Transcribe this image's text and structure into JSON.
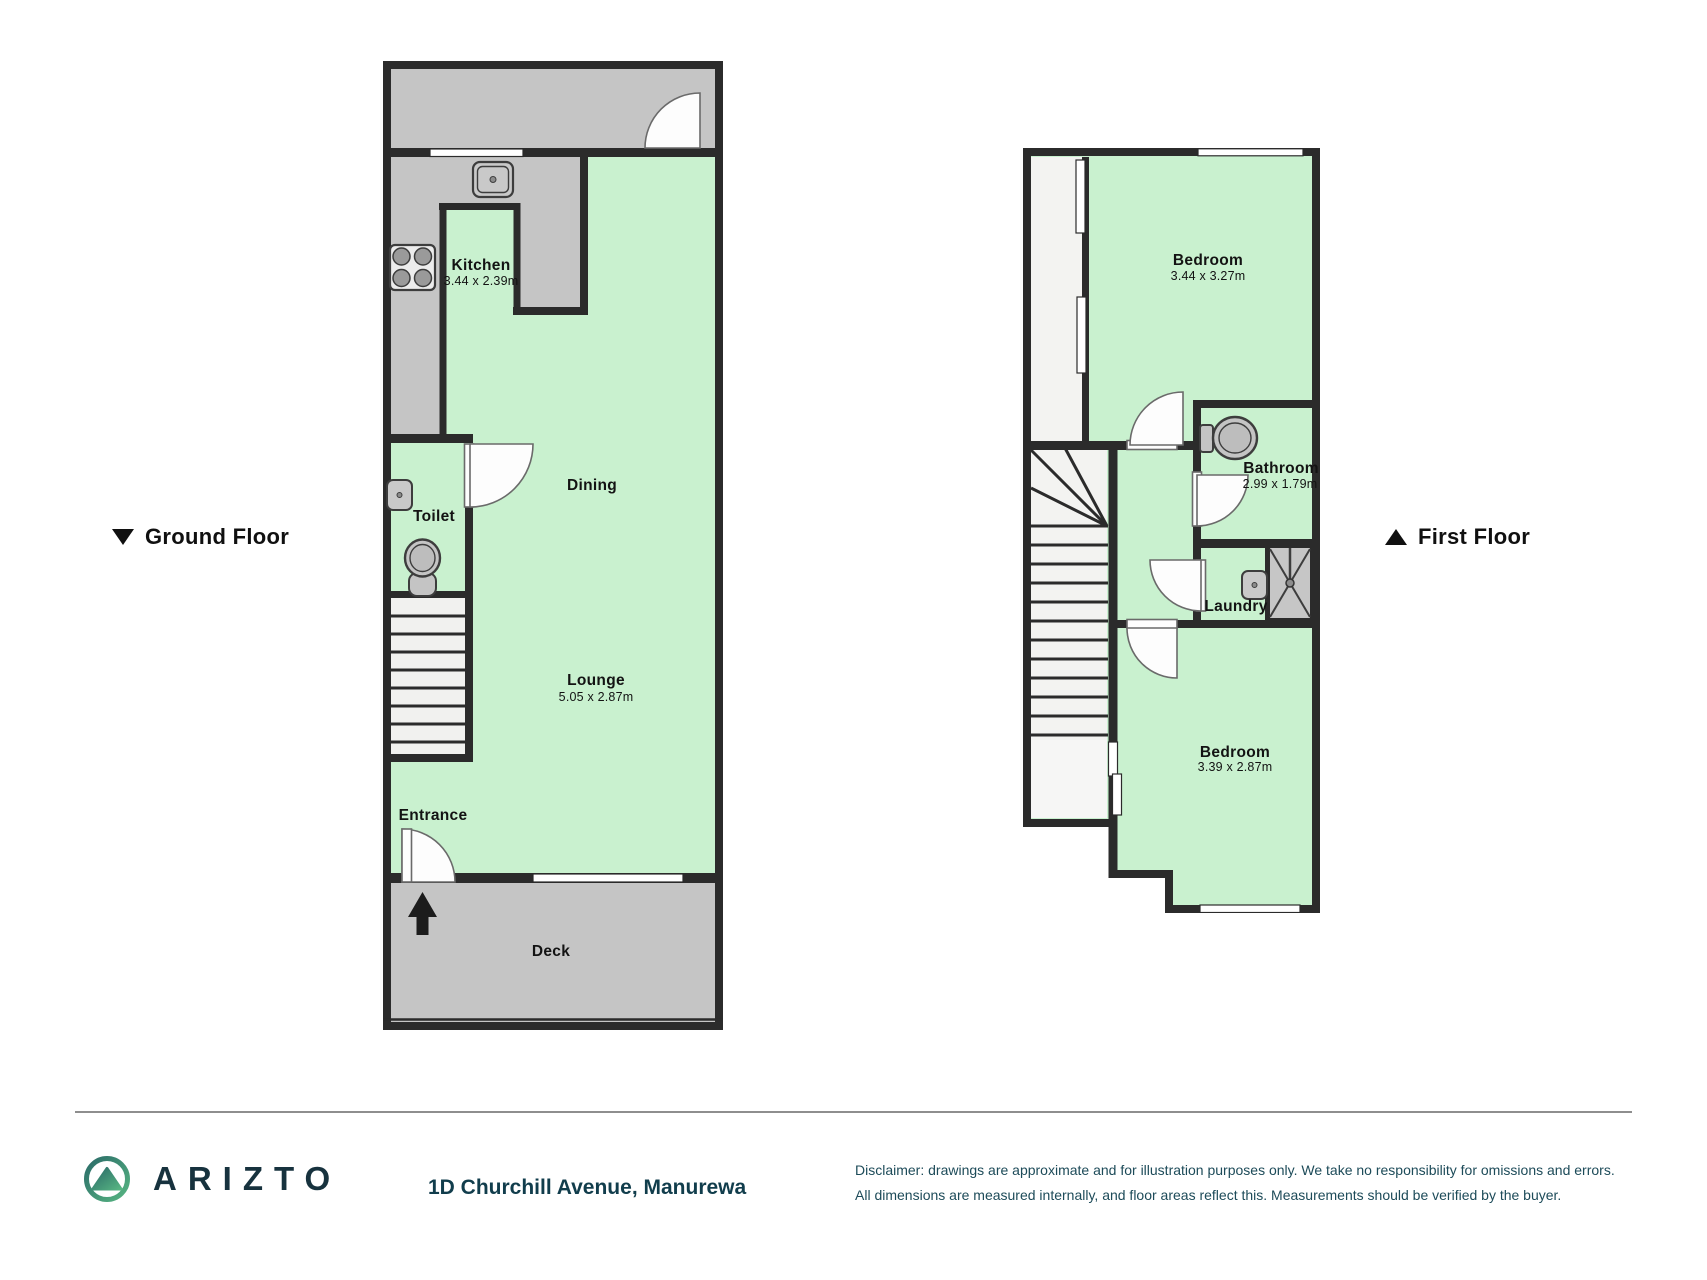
{
  "page": {
    "background": "#ffffff"
  },
  "colors": {
    "wall": "#2b2b2b",
    "room_green": "#c9f1cf",
    "area_gray": "#c5c5c5",
    "light_area": "#f3f3f1",
    "brand_teal": "#17323e",
    "footer_text": "#1d4b59"
  },
  "floors": {
    "ground": {
      "title": "Ground Floor",
      "marker": "down-triangle",
      "rooms": {
        "kitchen": {
          "name": "Kitchen",
          "dims": "3.44 x 2.39m"
        },
        "toilet": {
          "name": "Toilet"
        },
        "dining": {
          "name": "Dining"
        },
        "lounge": {
          "name": "Lounge",
          "dims": "5.05 x 2.87m"
        },
        "entrance": {
          "name": "Entrance"
        },
        "deck": {
          "name": "Deck"
        }
      },
      "fixtures": [
        "kitchen-sink",
        "stove",
        "toilet-sink",
        "toilet",
        "staircase",
        "entrance-arrow",
        "doors",
        "windows"
      ]
    },
    "first": {
      "title": "First Floor",
      "marker": "up-triangle",
      "rooms": {
        "bedroom1": {
          "name": "Bedroom",
          "dims": "3.44 x 3.27m"
        },
        "bathroom": {
          "name": "Bathroom",
          "dims": "2.99 x 1.79m"
        },
        "laundry": {
          "name": "Laundry"
        },
        "bedroom2": {
          "name": "Bedroom",
          "dims": "3.39 x 2.87m"
        }
      },
      "fixtures": [
        "toilet",
        "shower",
        "laundry-sink",
        "staircase",
        "doors",
        "windows"
      ]
    }
  },
  "footer": {
    "brand": "ARIZTO",
    "address": "1D Churchill Avenue, Manurewa",
    "disclaimer_line1": "Disclaimer: drawings are approximate and for illustration purposes only. We take no responsibility for omissions and errors.",
    "disclaimer_line2": "All dimensions are measured internally, and floor areas reflect this. Measurements should be verified by the buyer."
  }
}
